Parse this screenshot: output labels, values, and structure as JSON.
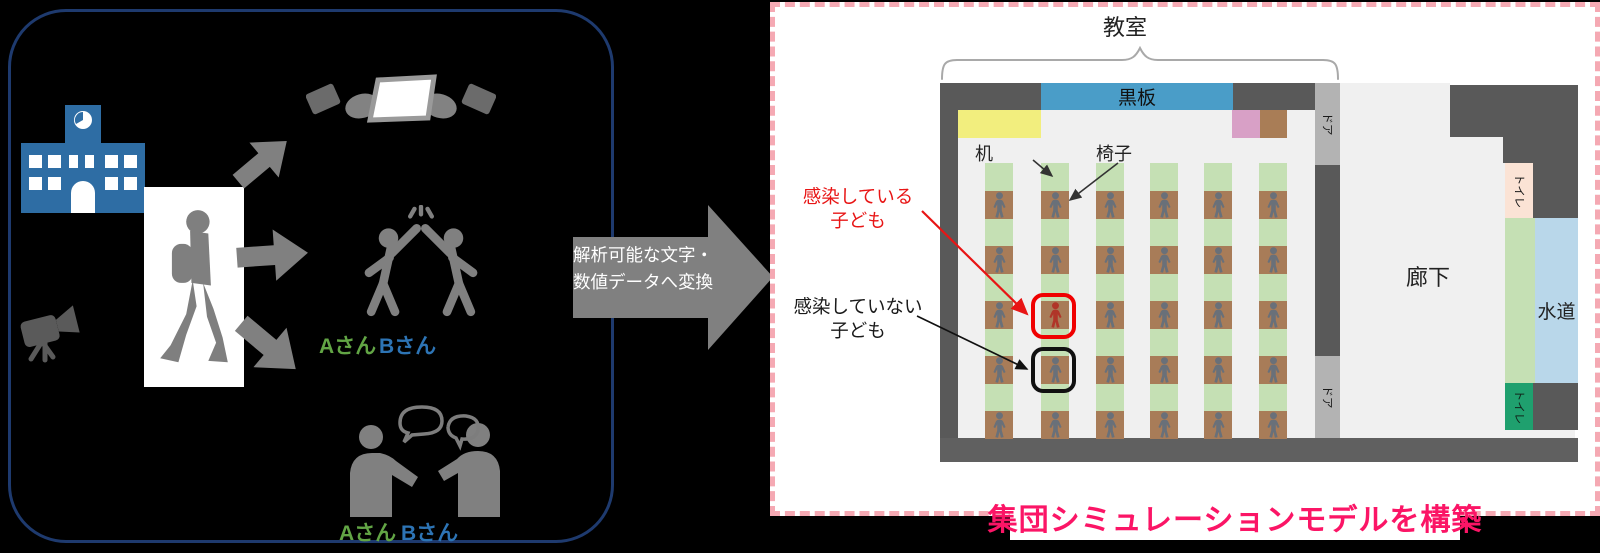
{
  "left_panel": {
    "highfive": {
      "label_a": "Aさん",
      "label_b": "Bさん"
    },
    "talk": {
      "label_a": "Aさん",
      "label_b": "Bさん"
    }
  },
  "transform_arrow": {
    "line1": "解析可能な文字・",
    "line2": "数値データへ変換"
  },
  "classroom": {
    "title": "教室",
    "blackboard": "黒板",
    "desk_label": "机",
    "chair_label": "椅子",
    "infected_line1": "感染している",
    "infected_line2": "子ども",
    "healthy_line1": "感染していない",
    "healthy_line2": "子ども",
    "corridor": "廊下",
    "water": "水道",
    "toilet_top": "トイレ",
    "toilet_bottom": "トイレ",
    "door_top": "ドア",
    "door_bottom": "ドア",
    "grid": {
      "columns": 6,
      "rows": 5,
      "infected_col": 1,
      "infected_row": 2,
      "outlined_col": 1,
      "outlined_row": 3
    }
  },
  "caption": {
    "text": "集団シミュレーションモデルを構築"
  },
  "colors": {
    "student": "#697079",
    "infected_student": "#b03528",
    "infected_outline": "#f00000",
    "healthy_outline": "#111111",
    "desk_green": "#c5e0b4",
    "chair_brown": "#a87c58",
    "caption_pink": "#fb1566",
    "label_a_green": "#62a545",
    "label_b_blue": "#2d74b5",
    "school_blue": "#2e6da4",
    "blackboard_blue": "#4a9dc8"
  }
}
